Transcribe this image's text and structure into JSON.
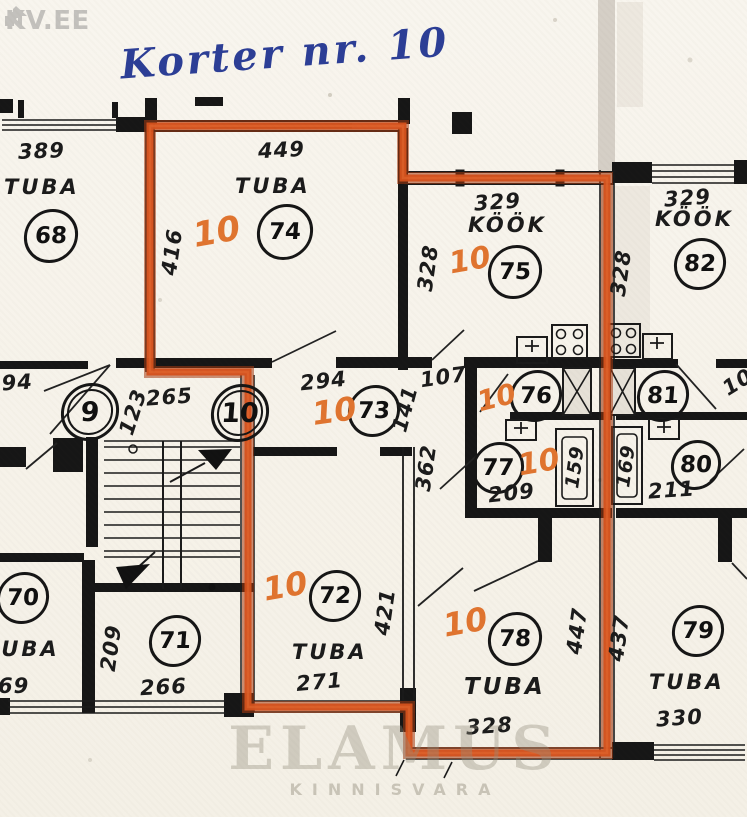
{
  "brand": {
    "logo": "KV.EE"
  },
  "note": "Korter nr. 10",
  "marker": "10",
  "watermark": {
    "l1": "ELAMUS",
    "l2": "KINNISVARA"
  },
  "colors": {
    "highlight_red": "#d4511c",
    "marker_orange": "#e0742f",
    "note_blue": "#2c3e96"
  },
  "rooms": {
    "r68": {
      "name": "TUBA",
      "num": "68"
    },
    "r74": {
      "name": "TUBA",
      "num": "74"
    },
    "r75": {
      "name": "KÖÖK",
      "num": "75"
    },
    "r82": {
      "name": "KÖÖK",
      "num": "82"
    },
    "r9": {
      "num": "9"
    },
    "r10": {
      "num": "10"
    },
    "r73": {
      "num": "73"
    },
    "r76": {
      "num": "76"
    },
    "r81": {
      "num": "81"
    },
    "r77": {
      "num": "77"
    },
    "r80": {
      "num": "80"
    },
    "r70": {
      "name": "TUBA",
      "num": "70"
    },
    "r71": {
      "num": "71"
    },
    "r72": {
      "name": "TUBA",
      "num": "72"
    },
    "r78": {
      "name": "TUBA",
      "num": "78"
    },
    "r79": {
      "name": "TUBA",
      "num": "79"
    }
  },
  "dims": {
    "t68_w": "389",
    "t74_w": "449",
    "t74_h": "416",
    "k75_w": "329",
    "k75_h": "328",
    "k82_w": "329",
    "k82_h": "328",
    "hall9_w": "294",
    "hall9_len": "265",
    "hall9_d": "123",
    "cor73_w": "294",
    "cor73_d": "141",
    "door_w": "107",
    "hall_len": "362",
    "wc77_w": "209",
    "tub_l": "159",
    "tub_r": "169",
    "wc80_w": "211",
    "edge_r": "10",
    "t70_num": "69",
    "t71_h": "209",
    "t71_w": "266",
    "t72_w": "271",
    "t72_h": "421",
    "t78_w": "328",
    "t78_h": "447",
    "party_h": "437",
    "t79_w": "330"
  }
}
